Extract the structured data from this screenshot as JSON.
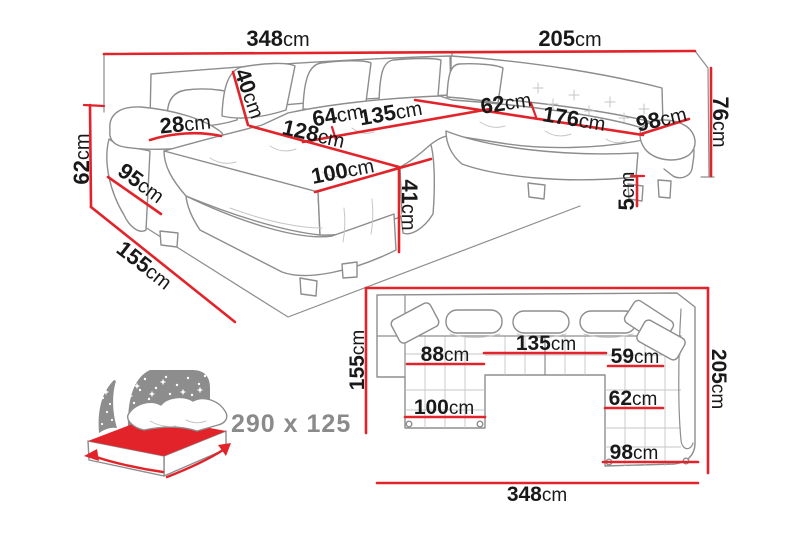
{
  "colors": {
    "accent": "#e2232a",
    "ink": "#191919",
    "sketch": "#8d8d8d",
    "sketch_light": "#c6c6c6",
    "muted": "#8a8a8a"
  },
  "perspective_view": {
    "labels": {
      "overall_width_left": {
        "value": "348",
        "unit": "cm"
      },
      "overall_width_right": {
        "value": "205",
        "unit": "cm"
      },
      "side_height": {
        "value": "62",
        "unit": "cm"
      },
      "overall_height": {
        "value": "76",
        "unit": "cm"
      },
      "back_pillow_height": {
        "value": "40",
        "unit": "cm"
      },
      "armrest_width": {
        "value": "28",
        "unit": "cm"
      },
      "left_seat_depth": {
        "value": "64",
        "unit": "cm"
      },
      "middle_seat_width": {
        "value": "135",
        "unit": "cm"
      },
      "right_seat_depth": {
        "value": "62",
        "unit": "cm"
      },
      "right_seat_length": {
        "value": "176",
        "unit": "cm"
      },
      "right_armrest_length": {
        "value": "98",
        "unit": "cm"
      },
      "chaise_length": {
        "value": "128",
        "unit": "cm"
      },
      "armrest_outer_length": {
        "value": "95",
        "unit": "cm"
      },
      "chaise_front_width": {
        "value": "100",
        "unit": "cm"
      },
      "seat_height": {
        "value": "41",
        "unit": "cm"
      },
      "leg_height": {
        "value": "5",
        "unit": "cm"
      },
      "side_depth": {
        "value": "155",
        "unit": "cm"
      }
    }
  },
  "sleeping_area": {
    "size_label": "290 x 125"
  },
  "top_view": {
    "labels": {
      "left_depth": {
        "value": "155",
        "unit": "cm"
      },
      "right_depth": {
        "value": "205",
        "unit": "cm"
      },
      "overall_width": {
        "value": "348",
        "unit": "cm"
      },
      "chaise_seat_width": {
        "value": "88",
        "unit": "cm"
      },
      "middle_seat_width": {
        "value": "135",
        "unit": "cm"
      },
      "right_seat_width": {
        "value": "59",
        "unit": "cm"
      },
      "chaise_overall_width": {
        "value": "100",
        "unit": "cm"
      },
      "right_seat_inner_width": {
        "value": "62",
        "unit": "cm"
      },
      "right_overall_width": {
        "value": "98",
        "unit": "cm"
      }
    }
  }
}
